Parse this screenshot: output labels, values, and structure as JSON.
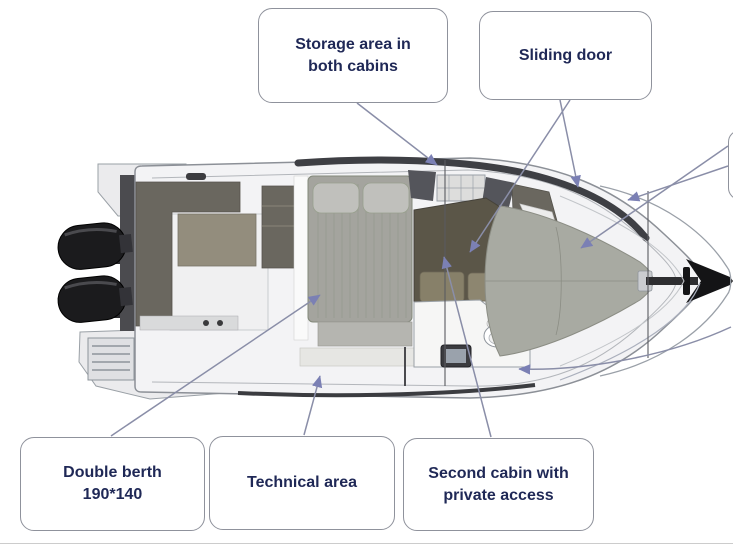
{
  "callouts": {
    "storage": {
      "label": "Storage area in\nboth cabins"
    },
    "sliding_door": {
      "label": "Sliding door"
    },
    "double_berth": {
      "label": "Double berth\n190*140"
    },
    "technical_area": {
      "label": "Technical area"
    },
    "second_cabin": {
      "label": "Second cabin with\nprivate access"
    }
  },
  "colors": {
    "label_text": "#1f2856",
    "box_border": "#8f929c",
    "arrow_head": "#7b80b4",
    "leader_line": "#8a8ea8",
    "hull_fill": "#f3f3f5",
    "hull_outline": "#8c9097",
    "furniture_dark": "#6a675f",
    "cabin_dark": "#5b5648",
    "mattress": "#a4a49e",
    "pillow": "#c0c0bc",
    "bow_cushion": "#a8aaa2",
    "engine": "#1b1b1d"
  }
}
